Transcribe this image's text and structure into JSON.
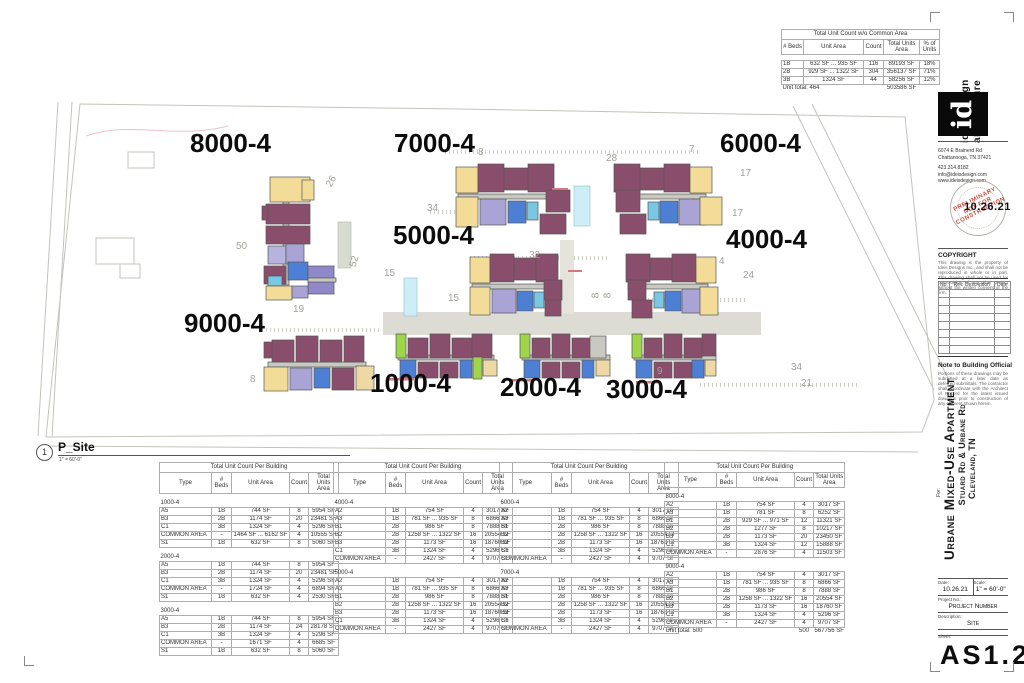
{
  "viewport": {
    "number": "1",
    "name": "P_Site",
    "scale": "1\" = 60'-0\""
  },
  "summary_table": {
    "title": "Total Unit Count w/o Common Area",
    "headers": [
      "# Beds",
      "Unit Area",
      "Count",
      "Total Units Area",
      "% of Units"
    ],
    "rows": [
      [
        "1B",
        "632 SF ... 935 SF",
        "116",
        "89193 SF",
        "18%"
      ],
      [
        "2B",
        "929 SF ... 1322 SF",
        "304",
        "356137 SF",
        "71%"
      ],
      [
        "3B",
        "1324 SF",
        "44",
        "58256 SF",
        "12%"
      ]
    ],
    "total_label": "Unit total: 464",
    "total_area": "503586 SF"
  },
  "building_tables": [
    {
      "title": "Total Unit Count Per Building",
      "headers": [
        "Type",
        "# Beds",
        "Unit Area",
        "Count",
        "Total Units Area"
      ],
      "groups": [
        {
          "name": "1000-4",
          "rows": [
            [
              "A5",
              "1B",
              "744 SF",
              "8",
              "5954 SF"
            ],
            [
              "B3",
              "2B",
              "1174 SF",
              "20",
              "23481 SF"
            ],
            [
              "C1",
              "3B",
              "1324 SF",
              "4",
              "5296 SF"
            ],
            [
              "COMMON AREA",
              "-",
              "1464 SF ... 6162 SF",
              "4",
              "10555 SF"
            ],
            [
              "S1",
              "1B",
              "632 SF",
              "8",
              "5060 SF"
            ]
          ]
        },
        {
          "name": "2000-4",
          "rows": [
            [
              "A5",
              "1B",
              "744 SF",
              "8",
              "5954 SF"
            ],
            [
              "B3",
              "2B",
              "1174 SF",
              "20",
              "23481 SF"
            ],
            [
              "C1",
              "3B",
              "1324 SF",
              "4",
              "5296 SF"
            ],
            [
              "COMMON AREA",
              "-",
              "1724 SF",
              "4",
              "6894 SF"
            ],
            [
              "S1",
              "1B",
              "632 SF",
              "4",
              "2530 SF"
            ]
          ]
        },
        {
          "name": "3000-4",
          "rows": [
            [
              "A5",
              "1B",
              "744 SF",
              "8",
              "5954 SF"
            ],
            [
              "B3",
              "2B",
              "1174 SF",
              "24",
              "28178 SF"
            ],
            [
              "C1",
              "3B",
              "1324 SF",
              "4",
              "5296 SF"
            ],
            [
              "COMMON AREA",
              "-",
              "1671 SF",
              "4",
              "6685 SF"
            ],
            [
              "S1",
              "1B",
              "632 SF",
              "8",
              "5060 SF"
            ]
          ]
        }
      ]
    },
    {
      "title": "Total Unit Count Per Building",
      "headers": [
        "Type",
        "# Beds",
        "Unit Area",
        "Count",
        "Total Units Area"
      ],
      "groups": [
        {
          "name": "4000-4",
          "rows": [
            [
              "A2",
              "1B",
              "754 SF",
              "4",
              "3017 SF"
            ],
            [
              "A3",
              "1B",
              "781 SF ... 935 SF",
              "8",
              "6866 SF"
            ],
            [
              "B1",
              "2B",
              "986 SF",
              "8",
              "7888 SF"
            ],
            [
              "B2",
              "2B",
              "1258 SF ... 1322 SF",
              "16",
              "20554 SF"
            ],
            [
              "B3",
              "2B",
              "1173 SF",
              "16",
              "18760 SF"
            ],
            [
              "C1",
              "3B",
              "1324 SF",
              "4",
              "5296 SF"
            ],
            [
              "COMMON AREA",
              "-",
              "2427 SF",
              "4",
              "9707 SF"
            ]
          ]
        },
        {
          "name": "5000-4",
          "rows": [
            [
              "A2",
              "1B",
              "754 SF",
              "4",
              "3017 SF"
            ],
            [
              "A3",
              "1B",
              "781 SF ... 935 SF",
              "8",
              "6866 SF"
            ],
            [
              "B1",
              "2B",
              "986 SF",
              "8",
              "7888 SF"
            ],
            [
              "B2",
              "2B",
              "1258 SF ... 1322 SF",
              "16",
              "20554 SF"
            ],
            [
              "B3",
              "2B",
              "1173 SF",
              "16",
              "18760 SF"
            ],
            [
              "C1",
              "3B",
              "1324 SF",
              "4",
              "5296 SF"
            ],
            [
              "COMMON AREA",
              "-",
              "2427 SF",
              "4",
              "9707 SF"
            ]
          ]
        }
      ]
    },
    {
      "title": "Total Unit Count Per Building",
      "headers": [
        "Type",
        "# Beds",
        "Unit Area",
        "Count",
        "Total Units Area"
      ],
      "groups": [
        {
          "name": "6000-4",
          "rows": [
            [
              "A2",
              "1B",
              "754 SF",
              "4",
              "3017 SF"
            ],
            [
              "A3",
              "1B",
              "781 SF ... 935 SF",
              "8",
              "6866 SF"
            ],
            [
              "B1",
              "2B",
              "986 SF",
              "8",
              "7888 SF"
            ],
            [
              "B2",
              "2B",
              "1258 SF ... 1322 SF",
              "16",
              "20554 SF"
            ],
            [
              "B3",
              "2B",
              "1173 SF",
              "16",
              "18760 SF"
            ],
            [
              "C1",
              "3B",
              "1324 SF",
              "4",
              "5296 SF"
            ],
            [
              "COMMON AREA",
              "-",
              "2427 SF",
              "4",
              "9707 SF"
            ]
          ]
        },
        {
          "name": "7000-4",
          "rows": [
            [
              "A2",
              "1B",
              "754 SF",
              "4",
              "3017 SF"
            ],
            [
              "A3",
              "1B",
              "781 SF ... 935 SF",
              "8",
              "6866 SF"
            ],
            [
              "B1",
              "2B",
              "986 SF",
              "8",
              "7888 SF"
            ],
            [
              "B2",
              "2B",
              "1258 SF ... 1322 SF",
              "16",
              "20554 SF"
            ],
            [
              "B3",
              "2B",
              "1173 SF",
              "16",
              "18760 SF"
            ],
            [
              "C1",
              "3B",
              "1324 SF",
              "4",
              "5296 SF"
            ],
            [
              "COMMON AREA",
              "-",
              "2427 SF",
              "4",
              "9707 SF"
            ]
          ]
        }
      ]
    },
    {
      "title": "Total Unit Count Per Building",
      "headers": [
        "Type",
        "# Beds",
        "Unit Area",
        "Count",
        "Total Units Area"
      ],
      "groups": [
        {
          "name": "8000-4",
          "rows": [
            [
              "A2",
              "1B",
              "754 SF",
              "4",
              "3017 SF"
            ],
            [
              "A3",
              "1B",
              "781 SF",
              "8",
              "6252 SF"
            ],
            [
              "B1",
              "2B",
              "929 SF ... 971 SF",
              "12",
              "11321 SF"
            ],
            [
              "B2",
              "2B",
              "1277 SF",
              "8",
              "10217 SF"
            ],
            [
              "B3",
              "2B",
              "1173 SF",
              "20",
              "23450 SF"
            ],
            [
              "C1",
              "3B",
              "1324 SF",
              "12",
              "15888 SF"
            ],
            [
              "COMMON AREA",
              "-",
              "2876 SF",
              "4",
              "11503 SF"
            ]
          ]
        },
        {
          "name": "9000-4",
          "rows": [
            [
              "A2",
              "1B",
              "754 SF",
              "4",
              "3017 SF"
            ],
            [
              "A3",
              "1B",
              "781 SF ... 935 SF",
              "8",
              "6866 SF"
            ],
            [
              "B1",
              "2B",
              "986 SF",
              "8",
              "7888 SF"
            ],
            [
              "B2",
              "2B",
              "1258 SF ... 1322 SF",
              "16",
              "20554 SF"
            ],
            [
              "B3",
              "2B",
              "1173 SF",
              "16",
              "18760 SF"
            ],
            [
              "C1",
              "3B",
              "1324 SF",
              "4",
              "5296 SF"
            ],
            [
              "COMMON AREA",
              "-",
              "2427 SF",
              "4",
              "9707 SF"
            ]
          ]
        }
      ],
      "footer": {
        "label": "Unit total: 500",
        "count": "500",
        "area": "567756 SF"
      }
    }
  ],
  "plan": {
    "building_labels": [
      {
        "label": "8000-4",
        "x": 190,
        "y": 128
      },
      {
        "label": "7000-4",
        "x": 394,
        "y": 128
      },
      {
        "label": "6000-4",
        "x": 720,
        "y": 128
      },
      {
        "label": "5000-4",
        "x": 393,
        "y": 220
      },
      {
        "label": "4000-4",
        "x": 726,
        "y": 224
      },
      {
        "label": "9000-4",
        "x": 184,
        "y": 308
      },
      {
        "label": "1000-4",
        "x": 370,
        "y": 368
      },
      {
        "label": "2000-4",
        "x": 500,
        "y": 372
      },
      {
        "label": "3000-4",
        "x": 606,
        "y": 374
      }
    ],
    "parking_numbers": [
      {
        "t": "26",
        "x": 326,
        "y": 176,
        "r": -60
      },
      {
        "t": "50",
        "x": 236,
        "y": 241,
        "r": 0
      },
      {
        "t": "52",
        "x": 349,
        "y": 256,
        "r": -75
      },
      {
        "t": "19",
        "x": 293,
        "y": 304,
        "r": 0
      },
      {
        "t": "8",
        "x": 250,
        "y": 374,
        "r": 0
      },
      {
        "t": "8",
        "x": 478,
        "y": 147,
        "r": 0
      },
      {
        "t": "28",
        "x": 606,
        "y": 153,
        "r": 0
      },
      {
        "t": "7",
        "x": 689,
        "y": 144,
        "r": 0
      },
      {
        "t": "17",
        "x": 740,
        "y": 168,
        "r": 0
      },
      {
        "t": "34",
        "x": 427,
        "y": 203,
        "r": 0
      },
      {
        "t": "17",
        "x": 732,
        "y": 208,
        "r": 0
      },
      {
        "t": "15",
        "x": 384,
        "y": 268,
        "r": 0
      },
      {
        "t": "32",
        "x": 529,
        "y": 250,
        "r": 0
      },
      {
        "t": "4",
        "x": 719,
        "y": 256,
        "r": 0
      },
      {
        "t": "24",
        "x": 743,
        "y": 270,
        "r": 0
      },
      {
        "t": "15",
        "x": 448,
        "y": 293,
        "r": 0
      },
      {
        "t": "8",
        "x": 593,
        "y": 290,
        "r": -90
      },
      {
        "t": "8",
        "x": 605,
        "y": 290,
        "r": -90
      },
      {
        "t": "34",
        "x": 791,
        "y": 362,
        "r": 0
      },
      {
        "t": "21",
        "x": 801,
        "y": 378,
        "r": 0
      },
      {
        "t": "9",
        "x": 657,
        "y": 366,
        "r": 0
      }
    ]
  },
  "titleblock": {
    "firm_line1": "ideis design",
    "firm_line2": "architecture",
    "logo_text": "id",
    "address_lines": [
      "6074 E Brainerd Rd",
      "Chattanooga, TN 37421",
      "",
      "423.314.8182",
      "info@ideisdesign.com",
      "www.ideisdesign.com"
    ],
    "stamp": {
      "line1": "Preliminary",
      "line2": "Not for Construction",
      "date": "10.26.21"
    },
    "copyright_title": "COPYRIGHT",
    "copyright_body": "This drawing is the property of Ideis Designs Inc., and shall not be reproduced in whole or in part. This drawing shall not be used for construction of any other project without the written consent of the firm.",
    "rev_table_headers": [
      "No.",
      "Rev. Description",
      "Date"
    ],
    "note_title": "Note to Building Official",
    "note_body": "Portions of these drawings may be submitted at a later date as deferred submittals. The contractor shall coordinate with the Architect of Record for the latest issued drawings prior to construction of any element shown herein.",
    "project_for": "For:",
    "project_title": "Urbane Mixed-Use Apartment",
    "project_address": "Stuard Rd & Urbane Rd",
    "project_city": "Cleveland, TN",
    "fields": {
      "date_label": "Date:",
      "date": "10.26.21",
      "scale_label": "Scale:",
      "scale": "1\" = 60'-0\"",
      "project_no_label": "Project No.:",
      "project_no": "Project Number",
      "description_label": "Description:",
      "description": "Site",
      "sheet_label": "Sheet:",
      "sheet": "AS1.2"
    }
  }
}
